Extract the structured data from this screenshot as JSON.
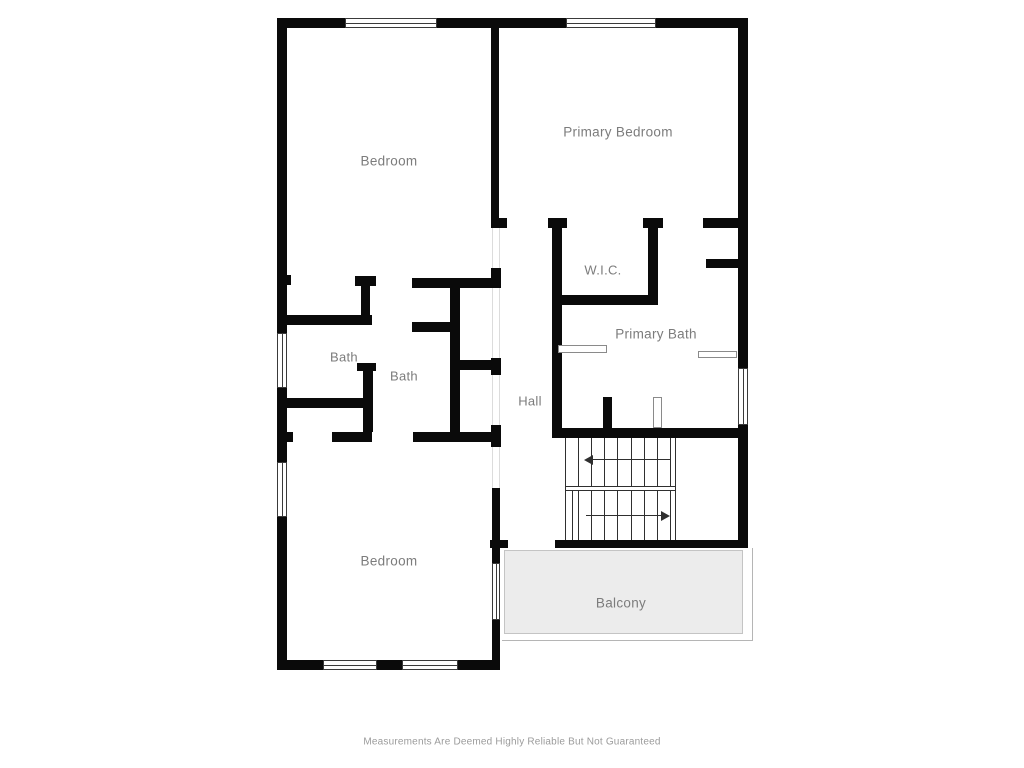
{
  "disclaimer": {
    "text": "Measurements Are Deemed Highly Reliable But Not Guaranteed"
  },
  "colors": {
    "wall": "#0a0a0a",
    "label": "#7c7c7c",
    "balcony_fill": "#ececec",
    "balcony_border": "#b5b5b5",
    "window_border": "#3a3a3a",
    "opening_line": "#dcdcdc",
    "fixture_border": "#8a8a8a",
    "stair_line": "#2f2f2f",
    "disclaimer": "#9b9b9b"
  },
  "plan": {
    "labels": [
      {
        "name": "room-label-bedroom-upper",
        "text": "Bedroom",
        "x": 389,
        "y": 161,
        "size": 13.5
      },
      {
        "name": "room-label-primary-bedroom",
        "text": "Primary Bedroom",
        "x": 618,
        "y": 132,
        "size": 13.5
      },
      {
        "name": "room-label-wic",
        "text": "W.I.C.",
        "x": 603,
        "y": 270,
        "size": 13
      },
      {
        "name": "room-label-bath-left",
        "text": "Bath",
        "x": 344,
        "y": 357,
        "size": 13
      },
      {
        "name": "room-label-bath-middle",
        "text": "Bath",
        "x": 404,
        "y": 376,
        "size": 13
      },
      {
        "name": "room-label-primary-bath",
        "text": "Primary Bath",
        "x": 656,
        "y": 334,
        "size": 13.5
      },
      {
        "name": "room-label-hall",
        "text": "Hall",
        "x": 530,
        "y": 401,
        "size": 13
      },
      {
        "name": "room-label-bedroom-lower",
        "text": "Bedroom",
        "x": 389,
        "y": 561,
        "size": 13.5
      },
      {
        "name": "room-label-balcony",
        "text": "Balcony",
        "x": 621,
        "y": 603,
        "size": 13.5
      }
    ],
    "walls": [
      [
        277,
        18,
        68,
        10
      ],
      [
        437,
        18,
        129,
        10
      ],
      [
        656,
        18,
        91,
        10
      ],
      [
        277,
        18,
        10,
        315
      ],
      [
        277,
        388,
        10,
        74
      ],
      [
        277,
        517,
        10,
        153
      ],
      [
        738,
        18,
        10,
        350
      ],
      [
        738,
        425,
        10,
        123
      ],
      [
        277,
        660,
        46,
        10
      ],
      [
        377,
        660,
        25,
        10
      ],
      [
        458,
        660,
        42,
        10
      ],
      [
        491,
        28,
        8,
        192
      ],
      [
        491,
        218,
        16,
        10
      ],
      [
        548,
        218,
        19,
        10
      ],
      [
        643,
        218,
        20,
        10
      ],
      [
        703,
        218,
        44,
        10
      ],
      [
        706,
        259,
        41,
        9
      ],
      [
        552,
        228,
        10,
        210
      ],
      [
        648,
        228,
        10,
        77
      ],
      [
        552,
        295,
        106,
        10
      ],
      [
        277,
        275,
        14,
        10
      ],
      [
        355,
        276,
        21,
        10
      ],
      [
        361,
        276,
        9,
        49
      ],
      [
        277,
        315,
        95,
        10
      ],
      [
        277,
        398,
        96,
        10
      ],
      [
        357,
        363,
        19,
        8
      ],
      [
        363,
        365,
        10,
        67
      ],
      [
        412,
        278,
        88,
        10
      ],
      [
        450,
        278,
        10,
        164
      ],
      [
        412,
        322,
        38,
        10
      ],
      [
        460,
        360,
        32,
        10
      ],
      [
        491,
        268,
        10,
        20
      ],
      [
        491,
        358,
        10,
        17
      ],
      [
        491,
        425,
        10,
        22
      ],
      [
        492,
        488,
        8,
        75
      ],
      [
        492,
        620,
        8,
        50
      ],
      [
        277,
        432,
        16,
        10
      ],
      [
        332,
        432,
        40,
        10
      ],
      [
        413,
        432,
        87,
        10
      ],
      [
        552,
        428,
        195,
        10
      ],
      [
        603,
        397,
        9,
        33
      ],
      [
        490,
        540,
        18,
        8
      ],
      [
        555,
        540,
        191,
        8
      ]
    ],
    "windows": [
      {
        "x": 345,
        "y": 18,
        "w": 92,
        "h": 10,
        "orient": "h"
      },
      {
        "x": 566,
        "y": 18,
        "w": 90,
        "h": 10,
        "orient": "h"
      },
      {
        "x": 277,
        "y": 333,
        "w": 10,
        "h": 55,
        "orient": "v"
      },
      {
        "x": 277,
        "y": 462,
        "w": 10,
        "h": 55,
        "orient": "v"
      },
      {
        "x": 738,
        "y": 368,
        "w": 10,
        "h": 57,
        "orient": "v"
      },
      {
        "x": 323,
        "y": 660,
        "w": 54,
        "h": 10,
        "orient": "h"
      },
      {
        "x": 402,
        "y": 660,
        "w": 56,
        "h": 10,
        "orient": "h"
      },
      {
        "x": 492,
        "y": 563,
        "w": 8,
        "h": 57,
        "orient": "v"
      }
    ],
    "openings": [
      {
        "x": 492,
        "y": 228,
        "w": 8,
        "h": 40
      },
      {
        "x": 492,
        "y": 288,
        "w": 8,
        "h": 70
      },
      {
        "x": 492,
        "y": 375,
        "w": 8,
        "h": 50
      },
      {
        "x": 492,
        "y": 447,
        "w": 8,
        "h": 41
      }
    ],
    "fixtures": [
      {
        "name": "vanity-counter-1",
        "x": 558,
        "y": 345,
        "w": 49,
        "h": 8
      },
      {
        "name": "vanity-counter-2",
        "x": 698,
        "y": 351,
        "w": 39,
        "h": 7
      },
      {
        "name": "stair-newel-post",
        "x": 653,
        "y": 397,
        "w": 9,
        "h": 31
      }
    ],
    "stairs": {
      "tread_xs": [
        578,
        591,
        604,
        617,
        631,
        644,
        657,
        670
      ],
      "upper_flight": {
        "y1": 438,
        "y2": 486
      },
      "lower_flight": {
        "y1": 490,
        "y2": 540
      },
      "divider_ys": [
        486,
        490
      ],
      "side_lines": [
        {
          "x": 565,
          "y1": 438,
          "y2": 540
        },
        {
          "x": 675,
          "y1": 438,
          "y2": 540
        },
        {
          "x": 572,
          "y1": 490,
          "y2": 540
        }
      ],
      "arrows": [
        {
          "y": 459,
          "x1": 586,
          "x2": 670,
          "dir": "left"
        },
        {
          "y": 515,
          "x1": 586,
          "x2": 668,
          "dir": "right"
        }
      ]
    },
    "balcony": {
      "outer": {
        "x": 502,
        "y": 548,
        "w": 251,
        "h": 93
      },
      "inner": {
        "x": 504,
        "y": 550,
        "w": 239,
        "h": 84
      }
    }
  }
}
